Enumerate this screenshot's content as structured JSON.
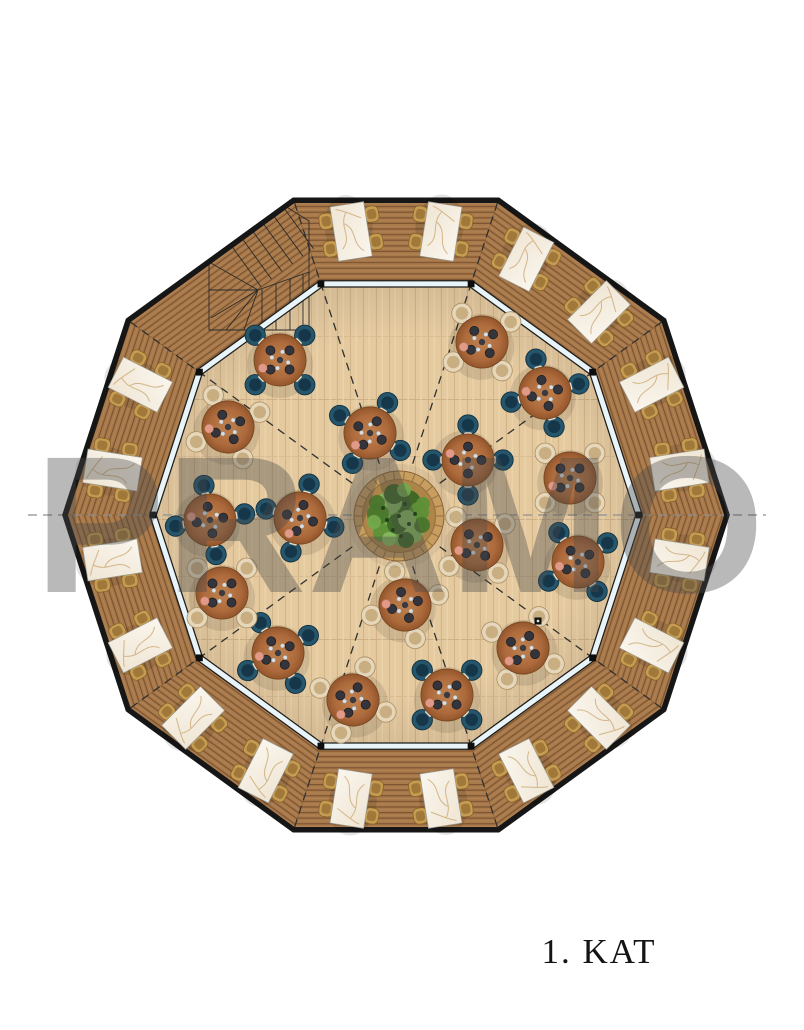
{
  "watermark": {
    "text": "PRAMO"
  },
  "floor_label": {
    "text": "1. KAT"
  },
  "plan": {
    "description": "decagonal restaurant floor plan, top view",
    "center": {
      "x": 396,
      "y": 515
    },
    "outer_radius": 331,
    "inner_radius": 243,
    "sides": 10,
    "start_angle_deg": 72,
    "section_line": {
      "x1": 28,
      "x2": 766
    },
    "deck": {
      "table_ring_radius": 287,
      "table_angles_deg": [
        81,
        99,
        45,
        63,
        9,
        27,
        333,
        351,
        297,
        315,
        261,
        279,
        225,
        243,
        189,
        207,
        153,
        171
      ],
      "chairs_per_table": 4,
      "table_count": 18
    },
    "dining_tables": [
      {
        "x": 280,
        "y": 360,
        "chairs": "navy",
        "rot": 0
      },
      {
        "x": 228,
        "y": 427,
        "chairs": "beige",
        "rot": 20
      },
      {
        "x": 370,
        "y": 433,
        "chairs": "navy",
        "rot": -15
      },
      {
        "x": 482,
        "y": 342,
        "chairs": "beige",
        "rot": 10
      },
      {
        "x": 545,
        "y": 393,
        "chairs": "navy",
        "rot": 30
      },
      {
        "x": 468,
        "y": 460,
        "chairs": "navy",
        "rot": 45
      },
      {
        "x": 570,
        "y": 478,
        "chairs": "beige",
        "rot": 0
      },
      {
        "x": 578,
        "y": 562,
        "chairs": "navy",
        "rot": 12
      },
      {
        "x": 523,
        "y": 648,
        "chairs": "beige",
        "rot": -18
      },
      {
        "x": 477,
        "y": 545,
        "chairs": "beige",
        "rot": 8
      },
      {
        "x": 405,
        "y": 605,
        "chairs": "beige",
        "rot": 28
      },
      {
        "x": 447,
        "y": 695,
        "chairs": "navy",
        "rot": 0
      },
      {
        "x": 353,
        "y": 700,
        "chairs": "beige",
        "rot": -25
      },
      {
        "x": 278,
        "y": 653,
        "chairs": "navy",
        "rot": 15
      },
      {
        "x": 222,
        "y": 593,
        "chairs": "beige",
        "rot": 0
      },
      {
        "x": 210,
        "y": 520,
        "chairs": "navy",
        "rot": 35
      },
      {
        "x": 300,
        "y": 518,
        "chairs": "navy",
        "rot": -30
      }
    ],
    "seats_per_dining_table": 4,
    "tree_planter": {
      "x": 399,
      "y": 516,
      "planter_r": 45,
      "canopy_r": 36
    },
    "floor_marker": {
      "x": 538,
      "y": 621
    },
    "staircase": {
      "location": "northwest deck corner",
      "type": "winder"
    }
  },
  "colors": {
    "deck_base": "#a8794b",
    "deck_line": "#7c5430",
    "deck_light": "#bb8e5e",
    "floor_base": "#e5caa0",
    "floor_line": "#d2b48a",
    "wall": "#161616",
    "glass": "#e8f4f8",
    "marble": "#f7f2e8",
    "marble_vein": "#c8a36b",
    "chair_gold": "#c59c52",
    "chair_gold_inner": "#a0783a",
    "chair_navy": "#26566c",
    "chair_navy_inner": "#16374a",
    "chair_beige": "#e6d7ba",
    "chair_beige_inner": "#c9ae82",
    "table_wood": "#b06c3e",
    "table_wood_dark": "#8a5026",
    "napkin": "#f2eee4",
    "plate": "#33343c",
    "pink_dot": "#e09a87",
    "planter": "#c79e60",
    "planter_tick": "#93703f",
    "soil": "#ad8549",
    "greens": [
      "#5e9038",
      "#49762c",
      "#74a84c",
      "#3c6625",
      "#86b75e"
    ],
    "dash_dark": "#303030",
    "dash_gray": "#8f8f8f",
    "watermark": "#4a4a4a",
    "label": "#141414"
  }
}
